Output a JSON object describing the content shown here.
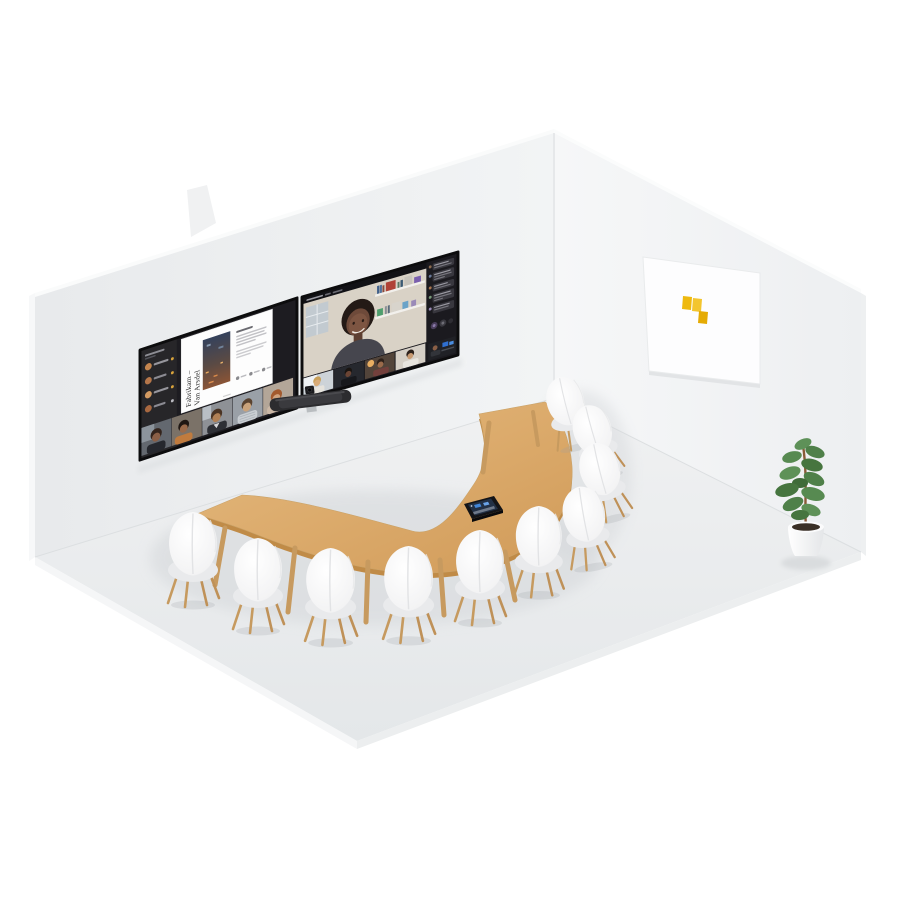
{
  "scene": {
    "description": "Isometric 3D render of a meeting room with a curved table, white chairs, dual wall displays running a video meeting, a wall video bar, a table touch console, a whiteboard with sticky notes and a potted plant",
    "background_color": "#ffffff"
  },
  "room": {
    "left_wall_color": "#edeff1",
    "right_wall_color": "#f3f5f6",
    "floor_color": "#e9ebed"
  },
  "left_display": {
    "kind": "content share screen",
    "document": {
      "title_line1": "Fabrikam –",
      "title_line2": "Van Arsdel"
    },
    "participant_list_rows": 4,
    "bottom_video_thumbnails": 5
  },
  "right_display": {
    "kind": "video gallery screen",
    "main_speaker_tiles": 1,
    "bottom_video_tiles": 4,
    "chat_messages": 5
  },
  "devices": {
    "soundbar": "wall-mounted video bar with camera",
    "console": "table touch console"
  },
  "furniture": {
    "table": "crescent / half-moon wooden table",
    "table_color": "#d9ab6e",
    "chairs": 10,
    "chair_color": "#f4f4f5"
  },
  "whiteboard": {
    "sticky_notes": 3,
    "sticky_note_color": "#eeb70d"
  },
  "plant": {
    "kind": "potted plant",
    "pot_color": "#fbfbfc",
    "leaf_color": "#548750"
  }
}
